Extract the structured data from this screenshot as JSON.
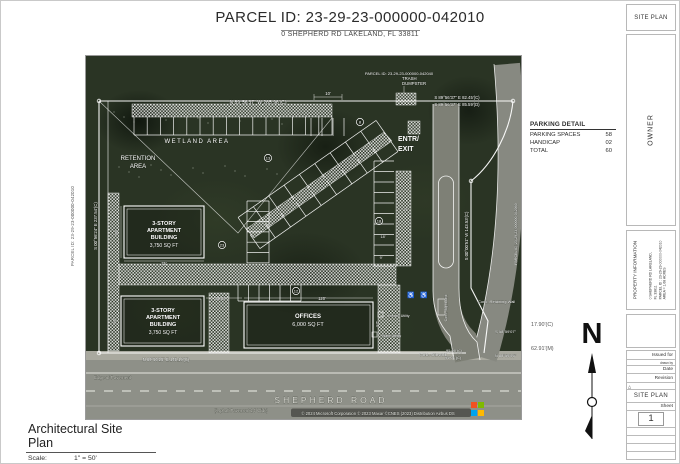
{
  "header": {
    "title": "PARCEL ID: 23-29-23-000000-042010",
    "subtitle": "0 SHEPHERD RD LAKELAND, FL 33811"
  },
  "sheet_corner": {
    "label": "SITE PLAN"
  },
  "owner_panel": {
    "label": "OWNER"
  },
  "property_panel": {
    "title": "PROPERTY INFORMATION",
    "address_line1": "0 SHEPHERD RD LAKELAND,",
    "address_line2": "FL 33811",
    "parcel_line": "PARCEL ID : 23-29-23-000000-042010",
    "area_line": "AREA = 1.68 ACRES"
  },
  "titleblock": {
    "issued_for": "Issued for",
    "drawn_by": "drawn by",
    "date": "Date",
    "revision": "Revision",
    "delta_icon": "△",
    "plan_name": "SITE PLAN",
    "sheet_label": "Sheet",
    "sheet_number": "1"
  },
  "parking_detail": {
    "title": "PARKING DETAIL",
    "rows": [
      {
        "label": "PARKING SPACES",
        "value": "58"
      },
      {
        "label": "HANDICAP",
        "value": "02"
      },
      {
        "label": "TOTAL",
        "value": "60"
      }
    ]
  },
  "plan_title": {
    "title": "Architectural Site Plan",
    "scale_label": "Scale:",
    "scale_value": "1\" = 50'"
  },
  "north_label": "N",
  "side_annotations": [
    {
      "text": "17.90'(C)"
    },
    {
      "text": "62.91'(M)"
    }
  ],
  "left_annotation": {
    "text": "PARCEL ID: 23-29-23-000000-042010"
  },
  "map": {
    "attribution": "© 2024 Microsoft Corporation © 2023 Maxar ©CNES (2023) Distribution Airbus DS",
    "ms_logo_colors": [
      "#f25022",
      "#7fba00",
      "#00a4ef",
      "#ffb900"
    ],
    "labels": [
      {
        "t": "PARCEL ID: 23-29-23-000000-042040",
        "x": 313,
        "y": 19,
        "s": 4,
        "a": "m"
      },
      {
        "t": "N 89°56'37\" W 265.96'(C)",
        "x": 172,
        "y": 48,
        "s": 5,
        "a": "m"
      },
      {
        "t": "S 89°56'37\" E 82.45'(C)",
        "x": 371,
        "y": 43,
        "s": 4.3,
        "a": "m"
      },
      {
        "t": "S 89°56'37\" E 85.59'(D)",
        "x": 371,
        "y": 50,
        "s": 4.3,
        "a": "m"
      },
      {
        "t": "TRASH",
        "x": 316,
        "y": 24,
        "s": 4.3,
        "a": "s"
      },
      {
        "t": "DUMPSTER",
        "x": 316,
        "y": 29,
        "s": 4.3,
        "a": "s"
      },
      {
        "t": "WETLAND  AREA",
        "x": 111,
        "y": 87,
        "s": 6,
        "a": "m",
        "ls": 1.5
      },
      {
        "t": "RETENTION",
        "x": 52,
        "y": 104,
        "s": 6,
        "a": "m"
      },
      {
        "t": "AREA",
        "x": 52,
        "y": 112,
        "s": 6,
        "a": "m"
      },
      {
        "t": "ENTR/",
        "x": 312,
        "y": 85,
        "s": 7,
        "a": "s",
        "w": 700
      },
      {
        "t": "EXIT",
        "x": 312,
        "y": 95,
        "s": 7,
        "a": "s",
        "w": 700
      },
      {
        "t": "3-STORY",
        "x": 78,
        "y": 169,
        "s": 5.5,
        "a": "m",
        "w": 700
      },
      {
        "t": "APARTMENT",
        "x": 78,
        "y": 176,
        "s": 5.5,
        "a": "m",
        "w": 700
      },
      {
        "t": "BUILDING",
        "x": 78,
        "y": 183,
        "s": 5.5,
        "a": "m",
        "w": 700
      },
      {
        "t": "3,750 SQ FT",
        "x": 78,
        "y": 191,
        "s": 5,
        "a": "m"
      },
      {
        "t": "3-STORY",
        "x": 77,
        "y": 256,
        "s": 5.5,
        "a": "m",
        "w": 700
      },
      {
        "t": "APARTMENT",
        "x": 77,
        "y": 263,
        "s": 5.5,
        "a": "m",
        "w": 700
      },
      {
        "t": "BUILDING",
        "x": 77,
        "y": 270,
        "s": 5.5,
        "a": "m",
        "w": 700
      },
      {
        "t": "3,750 SQ FT",
        "x": 77,
        "y": 278,
        "s": 5,
        "a": "m"
      },
      {
        "t": "OFFICES",
        "x": 222,
        "y": 262,
        "s": 6,
        "a": "m",
        "w": 700
      },
      {
        "t": "6,000 SQ FT",
        "x": 222,
        "y": 270,
        "s": 5.5,
        "a": "m"
      },
      {
        "t": "SHEPHERD  ROAD",
        "x": 245,
        "y": 347,
        "s": 8.5,
        "a": "m",
        "ls": 3,
        "c": "#d9d9d2"
      },
      {
        "t": "(Asphalt Pavement 24' Wide)",
        "x": 155,
        "y": 356,
        "s": 4.2,
        "a": "m",
        "c": "#cfcfc8"
      },
      {
        "t": "© 2024 Microsoft Corporation © 2023 Maxar ©CNES (2023) Distribution Airbus DS",
        "x": 292,
        "y": 359,
        "s": 4.2,
        "a": "m",
        "c": "#f0f0ec"
      },
      {
        "t": "Edge of Pavement",
        "x": 8,
        "y": 323,
        "s": 4.5,
        "a": "s",
        "c": "#cfcfc8"
      },
      {
        "t": "Conc. Sidewalk",
        "x": 347,
        "y": 300,
        "s": 4,
        "a": "m"
      },
      {
        "t": "N 89°50'25\" E 145.19'(C)",
        "x": 80,
        "y": 305,
        "s": 4.2,
        "a": "m"
      },
      {
        "t": "95.00'(C)",
        "x": 360,
        "y": 296,
        "s": 4,
        "a": "s"
      },
      {
        "t": "95.01'(C)",
        "x": 359,
        "y": 303,
        "s": 4,
        "a": "s"
      },
      {
        "t": "S 58°59'07\"",
        "x": 430,
        "y": 277,
        "s": 4,
        "a": "e"
      },
      {
        "t": "N 88°59'05\"",
        "x": 430,
        "y": 301,
        "s": 4,
        "a": "e"
      },
      {
        "t": "Conc. Retaining Wall",
        "x": 392,
        "y": 247,
        "s": 4,
        "a": "s"
      },
      {
        "t": "Electric Utility",
        "x": 302,
        "y": 261,
        "s": 3.6,
        "a": "s"
      },
      {
        "t": "Water Utility",
        "x": 296,
        "y": 281,
        "s": 3.6,
        "a": "s"
      },
      {
        "t": "S 00°00'51\" W 143.53'(C)",
        "x": 382,
        "y": 180,
        "s": 4.3,
        "a": "m",
        "r": -90
      },
      {
        "t": "S 00°56'24\" E 237.54'(C)",
        "x": 11,
        "y": 170,
        "s": 4.3,
        "a": "m",
        "r": -90
      },
      {
        "t": "PARCEL ID: 23-29-23-000000-042060",
        "x": 431,
        "y": 178,
        "s": 3.6,
        "a": "m",
        "r": -90
      },
      {
        "t": "Conc. Signboard",
        "x": 361,
        "y": 252,
        "s": 3.6,
        "a": "m",
        "r": -90
      },
      {
        "t": "10'",
        "x": 242,
        "y": 39,
        "s": 4.2,
        "a": "m"
      },
      {
        "t": "75'",
        "x": 78,
        "y": 209,
        "s": 4.2,
        "a": "m"
      },
      {
        "t": "50'",
        "x": 32,
        "y": 176,
        "s": 4.2,
        "a": "m",
        "r": -90
      },
      {
        "t": "50'",
        "x": 30,
        "y": 265,
        "s": 4.2,
        "a": "m",
        "r": -90
      },
      {
        "t": "120'",
        "x": 236,
        "y": 244,
        "s": 4.2,
        "a": "m"
      },
      {
        "t": "30.67'",
        "x": 135,
        "y": 244,
        "s": 4.2,
        "a": "m"
      },
      {
        "t": "57'",
        "x": 293,
        "y": 268,
        "s": 4.2,
        "a": "m",
        "r": -90
      },
      {
        "t": "18'",
        "x": 297,
        "y": 182,
        "s": 3.8,
        "a": "m"
      },
      {
        "t": "9'",
        "x": 295,
        "y": 203,
        "s": 3.8,
        "a": "m"
      },
      {
        "t": "15'",
        "x": 320,
        "y": 155,
        "s": 3.8,
        "a": "m"
      },
      {
        "t": "♿",
        "x": 325,
        "y": 241,
        "s": 6,
        "a": "m"
      },
      {
        "t": "♿",
        "x": 338,
        "y": 241,
        "s": 6,
        "a": "m"
      }
    ],
    "circled": [
      {
        "n": "8",
        "x": 274,
        "y": 66
      },
      {
        "n": "13",
        "x": 182,
        "y": 102
      },
      {
        "n": "18",
        "x": 293,
        "y": 165
      },
      {
        "n": "23",
        "x": 136,
        "y": 189
      },
      {
        "n": "12",
        "x": 210,
        "y": 235
      }
    ]
  }
}
